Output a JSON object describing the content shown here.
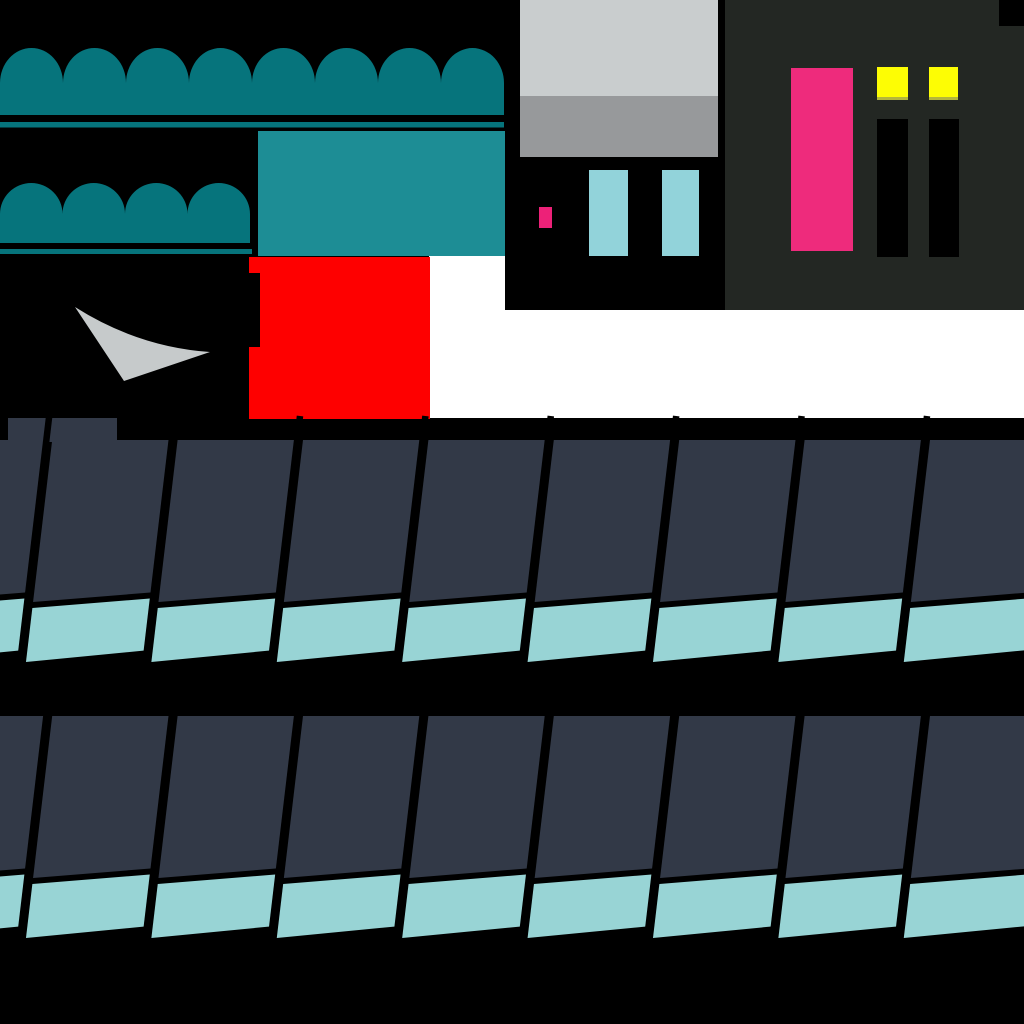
{
  "canvas": {
    "width": 1024,
    "height": 1024,
    "background": "#000000"
  },
  "colors": {
    "black": "#000000",
    "white": "#ffffff",
    "teal_dark": "#06747c",
    "teal_mid": "#1d8d95",
    "teal_strip": "#98d4d5",
    "cyan_light": "#92d3da",
    "slate": "#323947",
    "red": "#fe0000",
    "pink": "#ee2b7c",
    "pink_small": "#ed2178",
    "yellow": "#fdfd04",
    "yellow_edge": "#b4b63b",
    "gray_light": "#c9cdce",
    "gray_mid": "#97999b",
    "gray_arrow": "#c6cacb",
    "panel_bg": "#232723"
  },
  "sprites": {
    "white_backdrop": {
      "type": "rects",
      "items": [
        {
          "x": 429,
          "y": 255,
          "w": 595,
          "h": 163,
          "c": "white"
        }
      ]
    },
    "scallop_large": {
      "type": "scallop",
      "x": 0,
      "top": 48,
      "valley": 83,
      "bottom": 115,
      "arch_w": 63,
      "count": 8,
      "c": "teal_dark"
    },
    "underline_large": {
      "type": "rects",
      "items": [
        {
          "x": 0,
          "y": 122,
          "w": 504,
          "h": 5.5,
          "c": "teal_dark"
        }
      ]
    },
    "scallop_small": {
      "type": "scallop",
      "x": 0,
      "top": 183,
      "valley": 214,
      "bottom": 243,
      "arch_w": 62.5,
      "count": 4,
      "c": "teal_dark"
    },
    "underline_small": {
      "type": "rects",
      "items": [
        {
          "x": 0,
          "y": 249,
          "w": 252,
          "h": 5,
          "c": "teal_dark"
        }
      ]
    },
    "teal_canopy": {
      "type": "rects",
      "items": [
        {
          "x": 258,
          "y": 131,
          "w": 247,
          "h": 125,
          "c": "teal_mid"
        }
      ]
    },
    "red_block": {
      "type": "rects",
      "items": [
        {
          "x": 249,
          "y": 257,
          "w": 181,
          "h": 162,
          "c": "red"
        },
        {
          "x": 246,
          "y": 273,
          "w": 14,
          "h": 74,
          "c": "black"
        }
      ]
    },
    "swoosh_arrow": {
      "type": "path",
      "d": "M75,307 Q138,347 210,352 L124,381 Z",
      "c": "gray_arrow"
    },
    "window_block": {
      "type": "rects",
      "items": [
        {
          "x": 520,
          "y": 0,
          "w": 198,
          "h": 96,
          "c": "gray_light"
        },
        {
          "x": 520,
          "y": 96,
          "w": 198,
          "h": 61,
          "c": "gray_mid"
        }
      ]
    },
    "doorway_block": {
      "type": "rects",
      "items": [
        {
          "x": 505,
          "y": 157,
          "w": 220,
          "h": 153,
          "c": "black"
        },
        {
          "x": 589,
          "y": 170,
          "w": 39,
          "h": 86,
          "c": "cyan_light"
        },
        {
          "x": 662,
          "y": 170,
          "w": 37,
          "h": 86,
          "c": "cyan_light"
        },
        {
          "x": 539,
          "y": 207,
          "w": 13,
          "h": 21,
          "c": "pink_small"
        }
      ]
    },
    "control_panel": {
      "type": "rects",
      "items": [
        {
          "x": 725,
          "y": 0,
          "w": 299,
          "h": 310,
          "c": "panel_bg"
        },
        {
          "x": 999,
          "y": 0,
          "w": 25,
          "h": 26,
          "c": "black"
        },
        {
          "x": 791,
          "y": 68,
          "w": 62,
          "h": 183,
          "c": "pink"
        },
        {
          "x": 877,
          "y": 67,
          "w": 31,
          "h": 30,
          "c": "yellow"
        },
        {
          "x": 877,
          "y": 97,
          "w": 31,
          "h": 3,
          "c": "yellow_edge"
        },
        {
          "x": 929,
          "y": 67,
          "w": 29,
          "h": 30,
          "c": "yellow"
        },
        {
          "x": 929,
          "y": 97,
          "w": 29,
          "h": 3,
          "c": "yellow_edge"
        },
        {
          "x": 877,
          "y": 119,
          "w": 31,
          "h": 138,
          "c": "black"
        },
        {
          "x": 929,
          "y": 119,
          "w": 30,
          "h": 138,
          "c": "black"
        }
      ]
    },
    "roof_row_upper": {
      "type": "roof",
      "top": 440,
      "divider_start": 49.2,
      "pitch": 125.4,
      "panels_from": -1,
      "panels_to": 7,
      "panel_inset": 3,
      "dark_h_left": 162,
      "dark_h_right": 152,
      "gap": 6,
      "teal_h_left": 54,
      "teal_h_right": 52,
      "slant_dx": 30,
      "slant_dy": 254,
      "divider_width": 6.5,
      "divider_top_ext": 24,
      "divider_bottom": 230,
      "dark_c": "slate",
      "strip_c": "teal_strip",
      "line_c": "black",
      "raised": {
        "x": 8,
        "y": 418,
        "w": 109,
        "h": 24
      }
    },
    "roof_row_lower": {
      "type": "roof",
      "top": 716,
      "divider_start": 49.2,
      "pitch": 125.4,
      "panels_from": -1,
      "panels_to": 7,
      "panel_inset": 3,
      "dark_h_left": 162,
      "dark_h_right": 152,
      "gap": 6,
      "teal_h_left": 54,
      "teal_h_right": 52,
      "slant_dx": 30,
      "slant_dy": 254,
      "divider_width": 6.5,
      "divider_top_ext": 24,
      "divider_bottom": 230,
      "dark_c": "slate",
      "strip_c": "teal_strip",
      "line_c": "black"
    }
  }
}
